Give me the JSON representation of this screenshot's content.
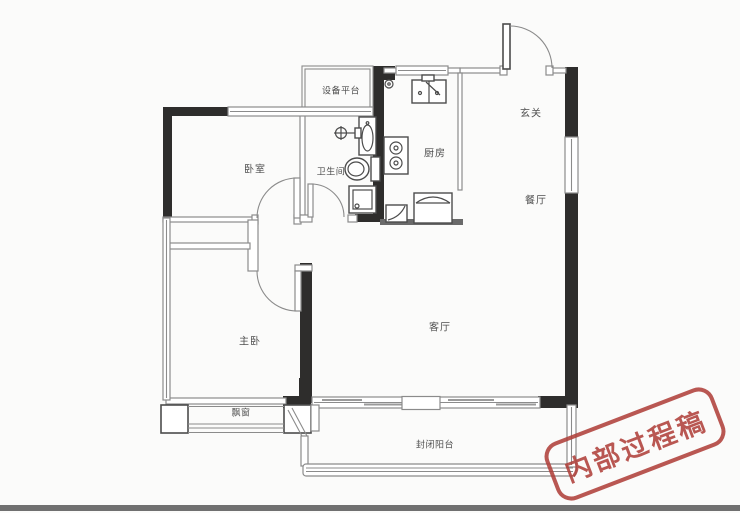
{
  "floorplan": {
    "rooms": [
      {
        "id": "bedroom",
        "label": "卧室"
      },
      {
        "id": "bathroom",
        "label": "卫生间"
      },
      {
        "id": "equipment-platform",
        "label": "设备平台"
      },
      {
        "id": "kitchen",
        "label": "厨房"
      },
      {
        "id": "entry",
        "label": "玄关"
      },
      {
        "id": "dining",
        "label": "餐厅"
      },
      {
        "id": "living",
        "label": "客厅"
      },
      {
        "id": "master-bedroom",
        "label": "主卧"
      },
      {
        "id": "bay-window",
        "label": "飘窗"
      },
      {
        "id": "balcony",
        "label": "封闭阳台"
      }
    ],
    "fixtures": [
      "entry-door",
      "bedroom-door",
      "master-bedroom-door",
      "bathroom-door",
      "kitchen-sink",
      "gas-stove",
      "refrigerator",
      "gas-meter",
      "bathroom-sink",
      "shower-head",
      "toilet",
      "shower-tray",
      "sliding-window",
      "bay-window-glazing",
      "balcony-glazing"
    ]
  },
  "stamp": {
    "text": "内部过程稿"
  },
  "colors": {
    "wall": "#2e2d2c",
    "line": "#8b8b8b",
    "fixture": "#4c4c4c",
    "label": "#4f4f4f",
    "stamp": "#b0413b",
    "background": "#fbfbfa",
    "photo_edge": "#707070"
  }
}
